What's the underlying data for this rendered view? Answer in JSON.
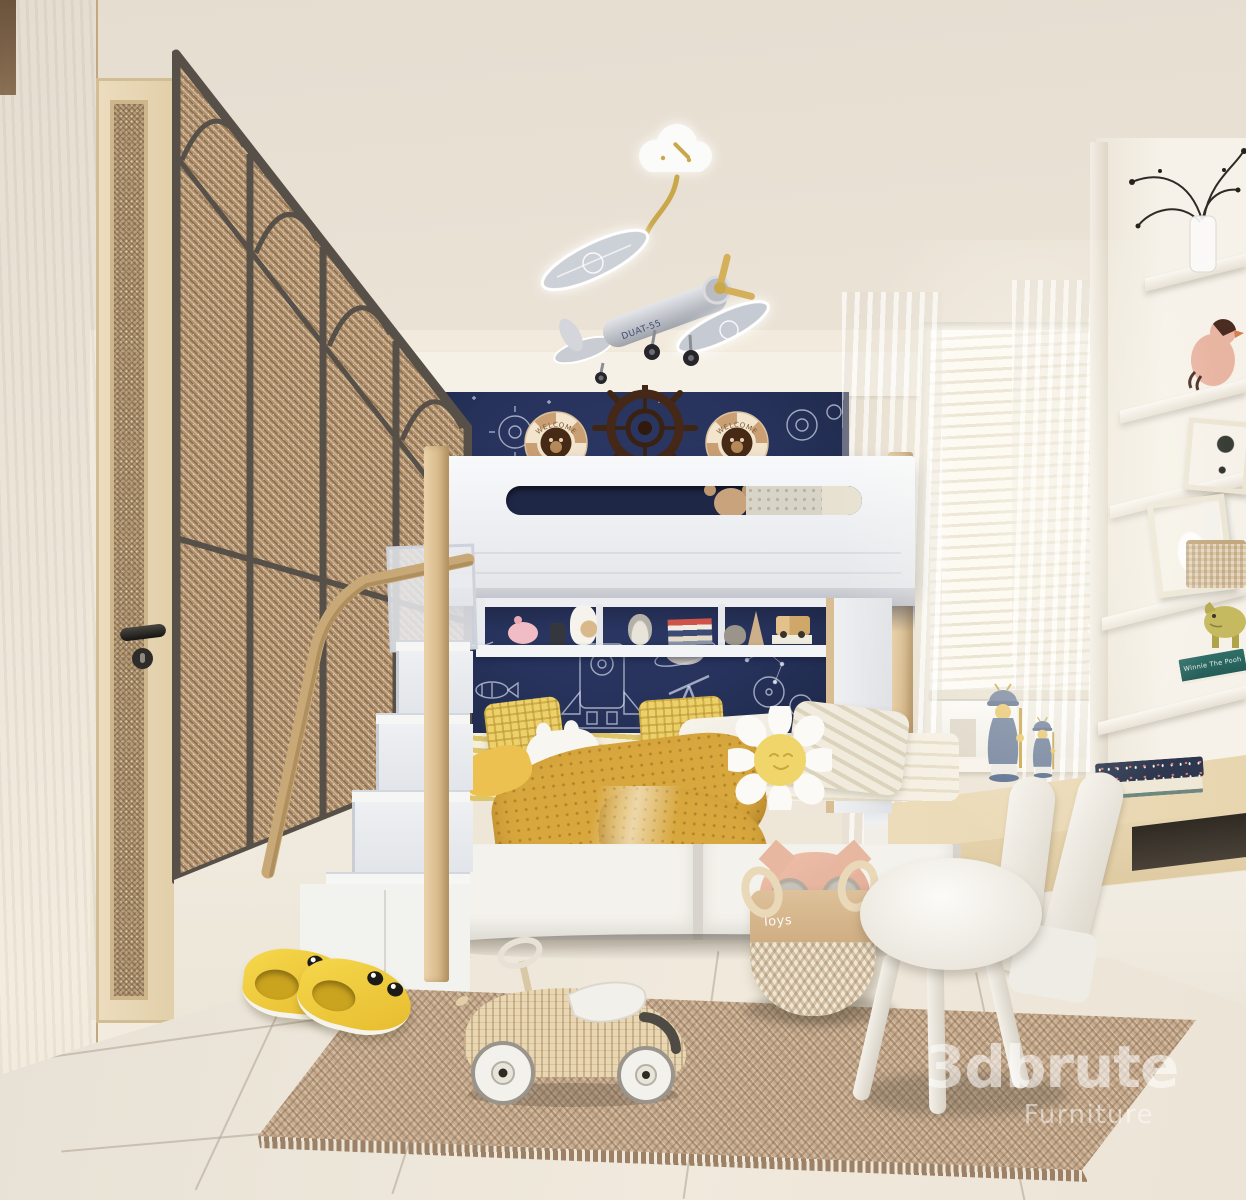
{
  "watermark": {
    "brand": "3dbrute",
    "tagline": "Furniture"
  },
  "labels": {
    "toy_basket": "Toys",
    "life_buoy": "WELCOME",
    "airplane_model": "DUAT-55",
    "book_spine": "Winnie The Pooh"
  },
  "colors": {
    "ceiling": "#eae2d7",
    "wall_cream": "#f0e9dd",
    "wall_navy": "#27335c",
    "doodle": "#d6dcec",
    "wood_light": "#c9a877",
    "cane_glass": "#b59a75",
    "metal_frame": "#565048",
    "bed_white": "#f4f4f5",
    "mattress_stripe": "#ddc569",
    "blanket_yellow": "#d8a73e",
    "rug_base": "#c9ae92",
    "floor": "#f0e9dc",
    "kick_dark": "#564e42",
    "desk_wood": "#ecdcba",
    "chair_white": "#f6f3ed",
    "slipper_yellow": "#e6bb2d",
    "buoy_cream": "#f2e4cd",
    "buoy_tan": "#cb9f74",
    "buoy_inner": "#462a15",
    "wheel_brown": "#452818",
    "gold": "#c9a84c",
    "plane_silver": "#c9ccd3",
    "watermark": "rgba(255,255,255,0.55)"
  }
}
